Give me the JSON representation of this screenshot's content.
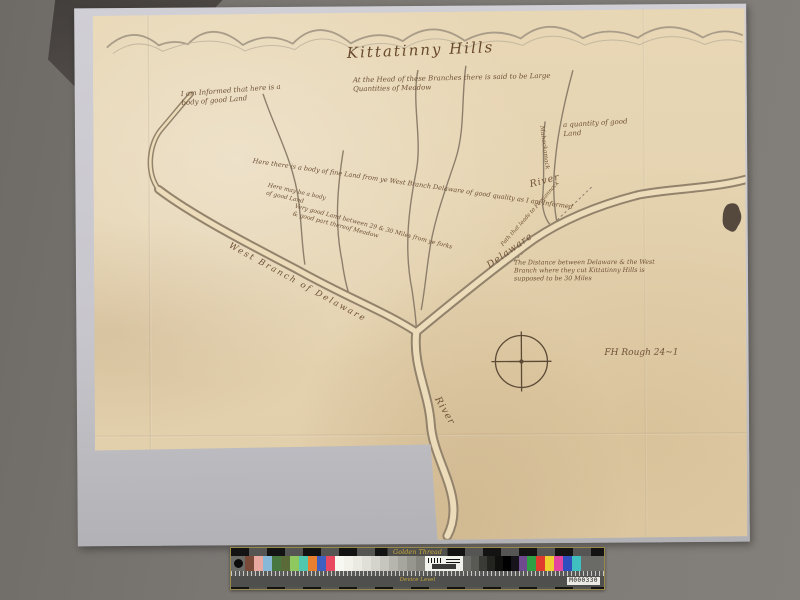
{
  "scene": {
    "background_color": "#7b7773",
    "backing_color": "#c8c7cd",
    "paper_color": "#e7d6b4",
    "ink_color": "#6f5136"
  },
  "map": {
    "title": "Kittatinny Hills",
    "notes": {
      "head": "At the Head of these Branches there is said to be Large Quantities of Meadow",
      "left": "I am Informed that here is a body of good Land",
      "quantity": "a quantity of good Land",
      "fine_land": "Here there is a body of fine Land from ye West Branch Delaware of good quality as I am Informed",
      "here_may": "Here may be a body of good Land",
      "miles": "Very good Land between 29 & 30 Miles from ye forks & good part thereof Meadow",
      "path": "Path that leads to Pequannock",
      "stream": "Mahackamack",
      "distance": "The Distance between Delaware & the West Branch where they cut Kittatinny Hills is supposed to be 30 Miles",
      "signature": "FH Rough 24~1"
    },
    "river_labels": {
      "west_branch": "West Branch of Delaware",
      "upper_delaware": "Delaware",
      "upper_river": "River",
      "lower_delaware": "Delaware",
      "lower_river": "River"
    }
  },
  "calibration_bar": {
    "brand": "Golden Thread",
    "subtitle": "Device Level",
    "serial": "M000330",
    "left_patches": [
      "#7a4a38",
      "#e8a8a0",
      "#88b8d8",
      "#487840",
      "#5a6a38",
      "#90c860",
      "#50c8b0",
      "#e88030",
      "#4060c0",
      "#e84860"
    ],
    "gray_ramp": [
      "#f8f8f2",
      "#f2f2ea",
      "#eaeae2",
      "#e0e0d8",
      "#d4d4cc",
      "#c6c6be",
      "#b6b6ae",
      "#a6a69e",
      "#96968e",
      "#86867e"
    ],
    "dark_patches": [
      "#5a5a55",
      "#3a3a36",
      "#232320",
      "#0f0f0e",
      "#000000",
      "#16141a",
      "#6f4a8f"
    ],
    "right_patches": [
      "#2f9f46",
      "#e0392e",
      "#efcf2f",
      "#e2469e",
      "#2f4fbf",
      "#3fbfbf"
    ]
  }
}
